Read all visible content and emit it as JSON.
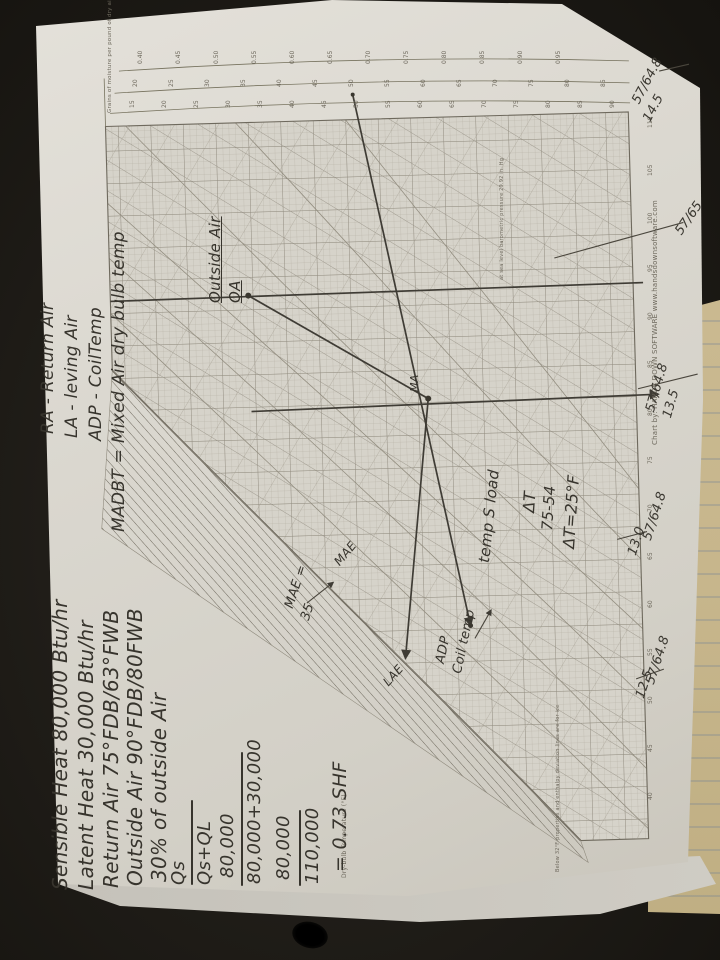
{
  "handwritten": {
    "left_notes": [
      "Sensible Heat 80,000 Btu/hr",
      "Latent Heat 30,000 Btu/hr",
      "Return Air 75°FDB/63°FWB",
      "Outside Air 90°FDB/80FWB",
      "30% of outside Air"
    ],
    "abbreviations": [
      "RA - Return Air",
      "LA - leving Air",
      "ADP - CoilTemp",
      "MADBT = Mixed Air dry bulb temp"
    ],
    "calc": {
      "num1": "Qs",
      "den1": "Qs+QL",
      "num2": "80,000",
      "den2": "80,000+30,000",
      "num3": "80,000",
      "den3": "110,000",
      "result": "= 0.73 SHF"
    },
    "points": {
      "outside_air": "Outside Air",
      "oa": "OA",
      "ma": "MA",
      "mae_curve": "MAE",
      "mae_label": "MAE =",
      "mae_value": "35",
      "lae": "LAE",
      "adp": "ADP",
      "coil_temp": "Coil temp",
      "temp_s_load": "temp S load",
      "delta_t": "ΔT",
      "delta_sub": "75-54",
      "delta_result": "ΔT=25°F"
    },
    "edge_readings": [
      {
        "pair": "57/64.8",
        "value": "14.5"
      },
      {
        "pair": "57/65",
        "value": ""
      },
      {
        "pair": "57/64.8",
        "value": "13.5"
      },
      {
        "pair": "57/64.8",
        "value": "13.0"
      },
      {
        "pair": "57/64.8",
        "value": "12.5"
      }
    ]
  },
  "printed": {
    "credit": "Chart by: HANDS DOWN SOFTWARE  www.handsdownsoftware.com",
    "pressure_note": "at sea level barometric pressure 29.92 in. Hg",
    "ice_note": "Below 32°F properties and enthalpy deviation lines are for ice",
    "axis_caption": "Dry-bulb Temperature (°F)",
    "grains_caption": "Grains of moisture per pound of dry air",
    "tick_rows": [
      {
        "name": "shf-scale",
        "x0": 138,
        "y0": 64,
        "dx": 38,
        "dy": 0,
        "fs": 6,
        "values": [
          "0.40",
          "0.45",
          "0.50",
          "0.55",
          "0.60",
          "0.65",
          "0.70",
          "0.75",
          "0.80",
          "0.85",
          "0.90",
          "0.95"
        ]
      },
      {
        "name": "enthalpy-scale",
        "x0": 133,
        "y0": 87,
        "dx": 36,
        "dy": 0,
        "fs": 6,
        "values": [
          "20",
          "25",
          "30",
          "35",
          "40",
          "45",
          "50",
          "55",
          "60",
          "65",
          "70",
          "75",
          "80",
          "85"
        ]
      },
      {
        "name": "grains-scale",
        "x0": 130,
        "y0": 108,
        "dx": 32,
        "dy": 0,
        "fs": 6,
        "values": [
          "15",
          "20",
          "25",
          "30",
          "35",
          "40",
          "45",
          "50",
          "55",
          "60",
          "65",
          "70",
          "75",
          "80",
          "85",
          "90"
        ]
      },
      {
        "name": "drybulb-axis",
        "x0": 648,
        "y0": 128,
        "dx": 0,
        "dy": 48,
        "fs": 6,
        "values": [
          "110",
          "105",
          "100",
          "95",
          "90",
          "85",
          "80",
          "75",
          "70",
          "65",
          "60",
          "55",
          "50",
          "45",
          "40"
        ]
      }
    ]
  }
}
